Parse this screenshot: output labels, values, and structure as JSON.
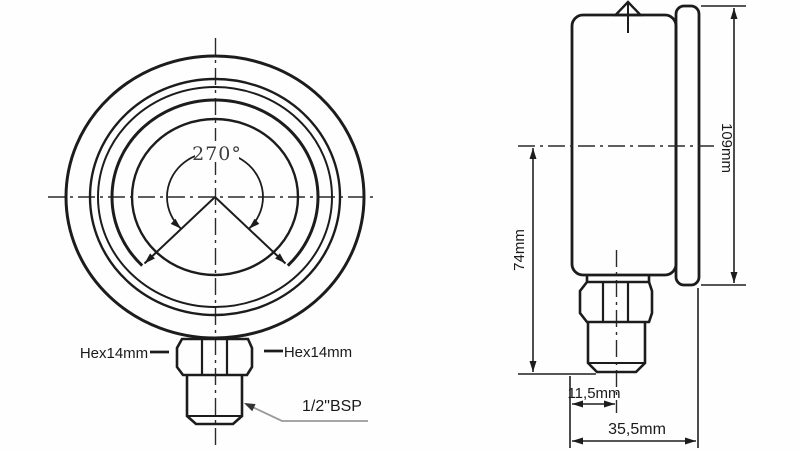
{
  "drawing": {
    "front_view": {
      "scale_angle_label": "270°",
      "hex_left_label": "Hex14mm",
      "hex_right_label": "Hex14mm",
      "thread_label": "1/2\"BSP"
    },
    "side_view": {
      "height_label": "109mm",
      "center_height_label": "74mm",
      "stem_offset_label": "11,5mm",
      "depth_label": "35,5mm"
    }
  }
}
